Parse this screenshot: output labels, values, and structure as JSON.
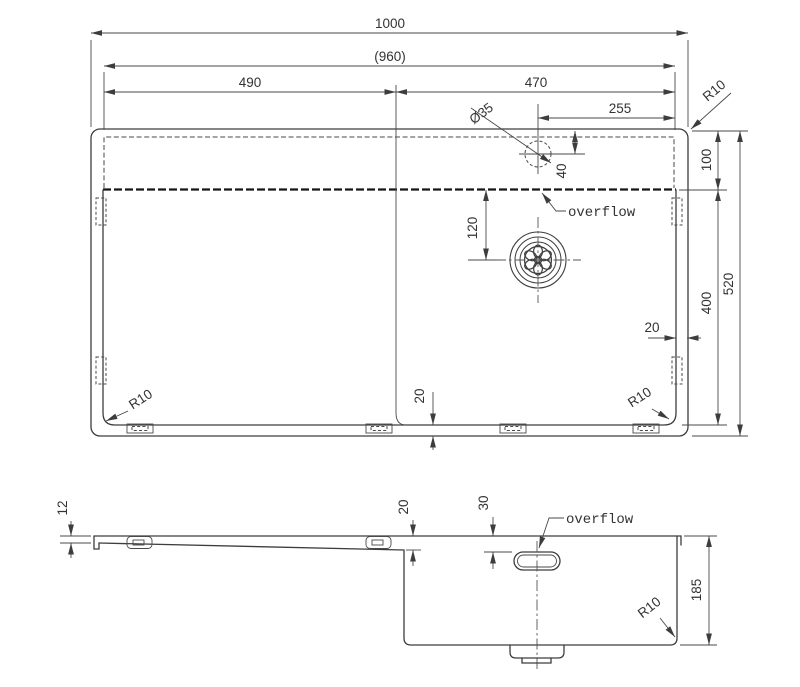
{
  "colors": {
    "line": "#3d3d3d",
    "heavy_line": "#161616",
    "text": "#333333",
    "background": "#ffffff"
  },
  "top_view": {
    "name": "sink top view",
    "dim_overall_width": "1000",
    "dim_rim_width": "(960)",
    "dim_drainboard_width": "490",
    "dim_bowl_width": "470",
    "dim_tap_to_edge": "255",
    "dim_tap_hole_dia": "Ø35",
    "dim_corner_radius_tr": "R10",
    "dim_deck_depth": "100",
    "dim_tap_hole_offset": "40",
    "dim_drain_offset": "120",
    "label_overflow": "overflow",
    "dim_basin_span": "400",
    "dim_overall_depth": "520",
    "dim_edge_gap_right": "20",
    "dim_edge_gap_bottom": "20",
    "dim_corner_radius_bl": "R10",
    "dim_corner_radius_br": "R10"
  },
  "side_view": {
    "name": "sink side section view",
    "dim_rim_height": "12",
    "dim_deck_drop": "20",
    "dim_overflow_offset": "30",
    "label_overflow": "overflow",
    "dim_bowl_depth": "185",
    "dim_corner_radius": "R10"
  }
}
